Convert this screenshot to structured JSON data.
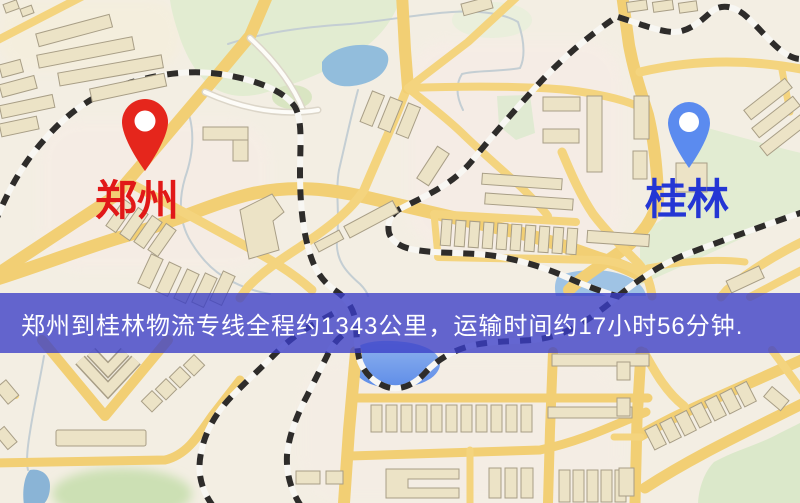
{
  "banner": {
    "text": "郑州到桂林物流专线全程约1343公里，运输时间约17小时56分钟.",
    "background_color": "#3A3EC6",
    "text_color": "#FFFFFF"
  },
  "markers": {
    "origin": {
      "label": "郑州",
      "label_color": "#E11818",
      "pin_color": "#E5261C",
      "pin_dot_color": "#FFFFFF"
    },
    "destination": {
      "label": "桂林",
      "label_color": "#2436D4",
      "pin_color": "#5B8BEF",
      "pin_dot_color": "#FFFFFF"
    }
  },
  "route": {
    "origin": "郑州",
    "destination": "桂林",
    "distance": "约1343公里",
    "duration": "约17小时56分钟"
  },
  "map_palette": {
    "background": "#F3EEE3",
    "road": "#F2CF74",
    "building": "#ECE3C6",
    "park": "#E2ECD2",
    "water": "#92BDDC",
    "water_bright": "#5E8DE8",
    "railway": "#2E2C2A"
  }
}
